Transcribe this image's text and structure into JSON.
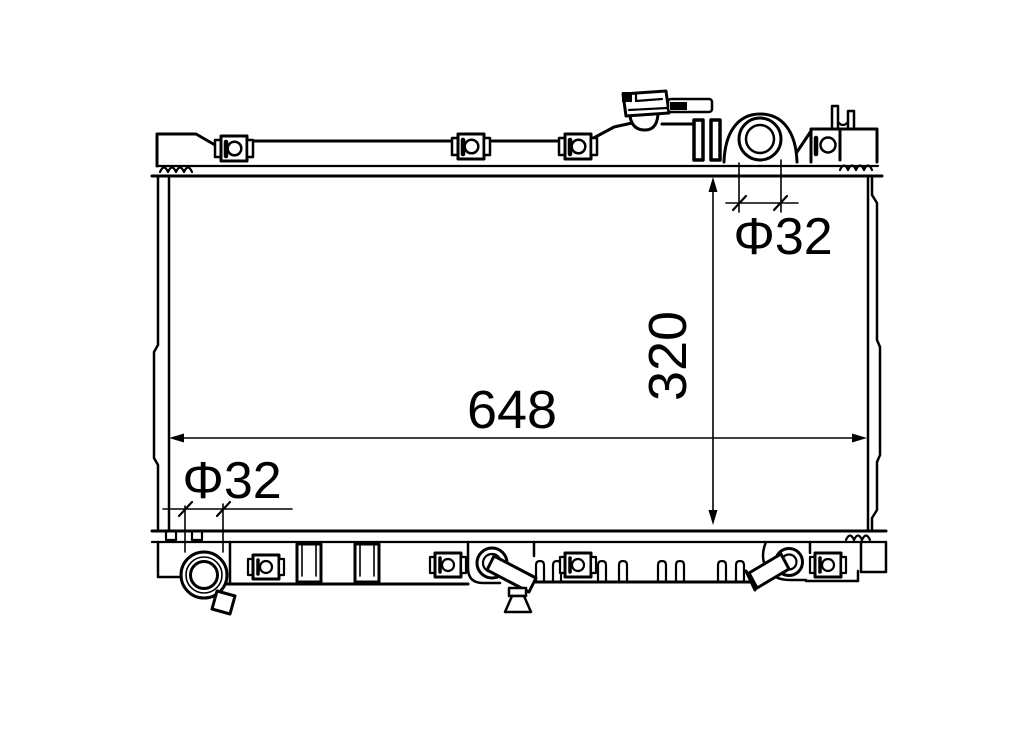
{
  "figure": {
    "title": "Radiator technical line drawing",
    "background_color": "#ffffff",
    "line_color": "#000000"
  },
  "dimensions": {
    "core_width": "648",
    "core_height": "320",
    "inlet_pipe_diameter": "Φ32",
    "outlet_pipe_diameter": "Φ32"
  }
}
